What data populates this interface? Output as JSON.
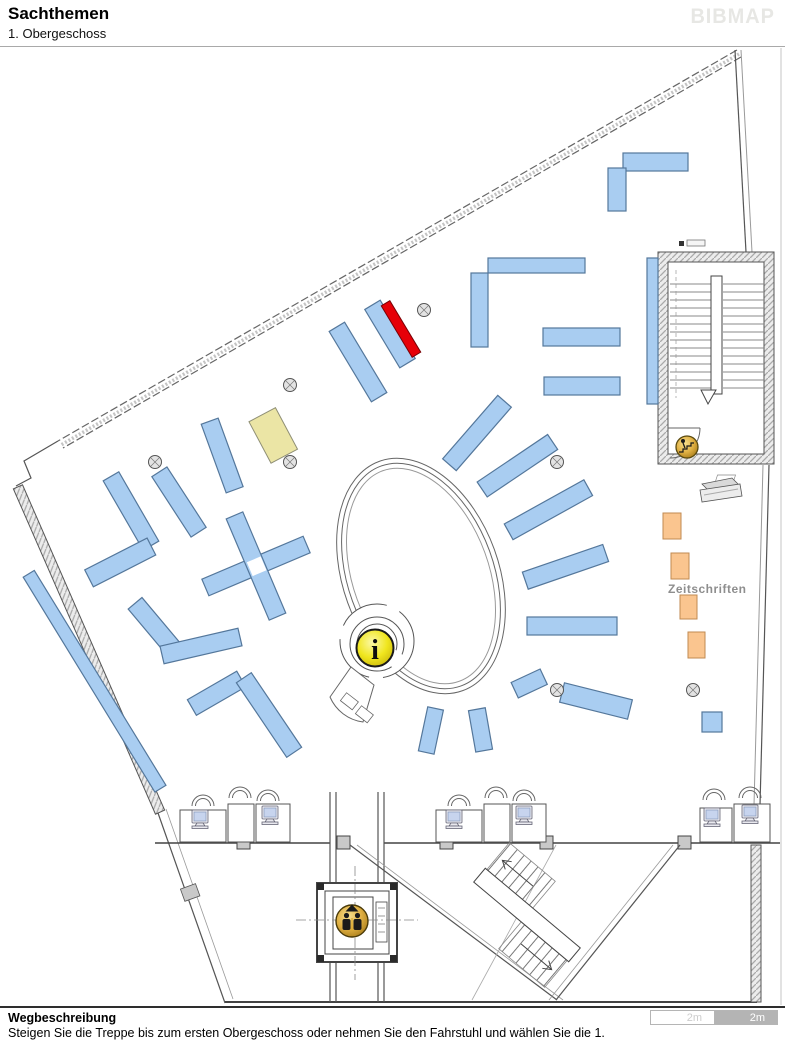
{
  "header": {
    "title": "Sachthemen",
    "subtitle": "1. Obergeschoss",
    "brand": "BIBMAP"
  },
  "map": {
    "labels": {
      "magazines": "Zeitschriften"
    },
    "info_icon": {
      "letter": "i"
    },
    "icons": [
      "info-icon",
      "elevator-icon",
      "stairs-icon",
      "computer-workstation-icon",
      "copier-icon",
      "column-icon"
    ],
    "colors": {
      "bookshelf": "#A9CDF1",
      "bookshelf_border": "#54779B",
      "highlight": "#E60008",
      "highlight_border": "#7A0005",
      "special_shelf": "#EBE5A5",
      "special_shelf_border": "#8F8F75",
      "magazine_shelf": "#FAC58F",
      "magazine_shelf_border": "#C08A52",
      "info_yellow": "#F0E61E",
      "icon_gold": "#D9A930",
      "wall": "#555555"
    }
  },
  "footer": {
    "heading": "Wegbeschreibung",
    "description": "Steigen Sie die Treppe bis zum ersten Obergeschoss oder nehmen Sie den Fahrstuhl und wählen Sie die 1.",
    "scale": {
      "segments": [
        {
          "label": "2m"
        },
        {
          "label": "2m"
        }
      ]
    }
  }
}
